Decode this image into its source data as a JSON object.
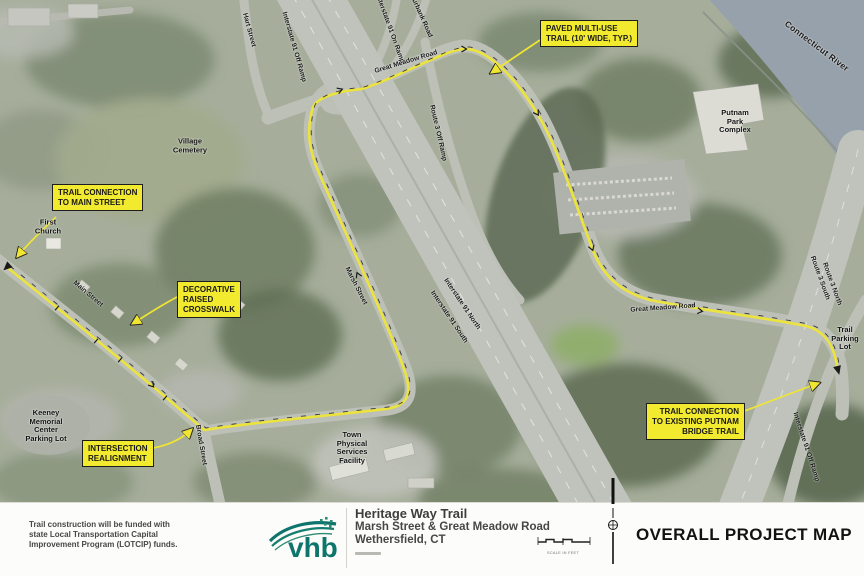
{
  "colors": {
    "callout_yellow": "#F2EA2F",
    "trail_yellow": "#ECE43C",
    "river_gray_blue": "#97A1AB",
    "road_gray": "#BFC2BA",
    "land_green": "#A6AE9B",
    "footer_background": "#FCFCFA",
    "logo_teal": "#0E756C",
    "text_dark": "#1D1D1D"
  },
  "map": {
    "callouts": [
      {
        "id": "paved-multi-use-trail",
        "lines": [
          "PAVED MULTI-USE",
          "TRAIL (10' WIDE, TYP.)"
        ]
      },
      {
        "id": "trail-connection-main-street",
        "lines": [
          "TRAIL CONNECTION",
          "TO MAIN STREET"
        ]
      },
      {
        "id": "decorative-raised-crosswalk",
        "lines": [
          "DECORATIVE",
          "RAISED",
          "CROSSWALK"
        ]
      },
      {
        "id": "intersection-realignment",
        "lines": [
          "INTERSECTION",
          "REALIGNMENT"
        ]
      },
      {
        "id": "trail-connection-putnam-bridge",
        "lines": [
          "TRAIL CONNECTION",
          "TO EXISTING PUTNAM",
          "BRIDGE TRAIL"
        ]
      }
    ],
    "rotated_labels": [
      {
        "text": "Hart Street"
      },
      {
        "text": "Interstate 91 Off Ramp"
      },
      {
        "text": "Interstate 91 On Ramp"
      },
      {
        "text": "Burbank Road"
      },
      {
        "text": "Great Meadow Road"
      },
      {
        "text": "Route 3 Off Ramp"
      },
      {
        "text": "Interstate 91 North"
      },
      {
        "text": "Interstate 91 South"
      },
      {
        "text": "Marsh Street"
      },
      {
        "text": "Main Street"
      },
      {
        "text": "Broad Street"
      },
      {
        "text": "Great Meadow Road"
      },
      {
        "text": "Route 3 South"
      },
      {
        "text": "Route 3 North"
      },
      {
        "text": "Interstate 91 Off Ramp"
      },
      {
        "text": "Connecticut River"
      }
    ],
    "place_labels": [
      {
        "id": "village-cemetery",
        "lines": [
          "Village",
          "Cemetery"
        ]
      },
      {
        "id": "first-church",
        "lines": [
          "First",
          "Church"
        ]
      },
      {
        "id": "keeney-memorial",
        "lines": [
          "Keeney",
          "Memorial",
          "Center",
          "Parking Lot"
        ]
      },
      {
        "id": "town-physical",
        "lines": [
          "Town",
          "Physical",
          "Services",
          "Facility"
        ]
      },
      {
        "id": "putnam-park",
        "lines": [
          "Putnam",
          "Park",
          "Complex"
        ]
      },
      {
        "id": "trail-parking",
        "lines": [
          "Trail",
          "Parking",
          "Lot"
        ]
      }
    ]
  },
  "footer": {
    "funding_note_lines": [
      "Trail construction will be funded with",
      "state Local Transportation Capital",
      "Improvement Program (LOTCIP) funds."
    ],
    "logo_text": "vhb",
    "project_title": "Heritage Way Trail",
    "project_subtitle": "Marsh Street & Great Meadow Road",
    "project_location": "Wethersfield, CT",
    "scale_caption": "SCALE IN FEET",
    "map_title": "OVERALL PROJECT MAP"
  }
}
